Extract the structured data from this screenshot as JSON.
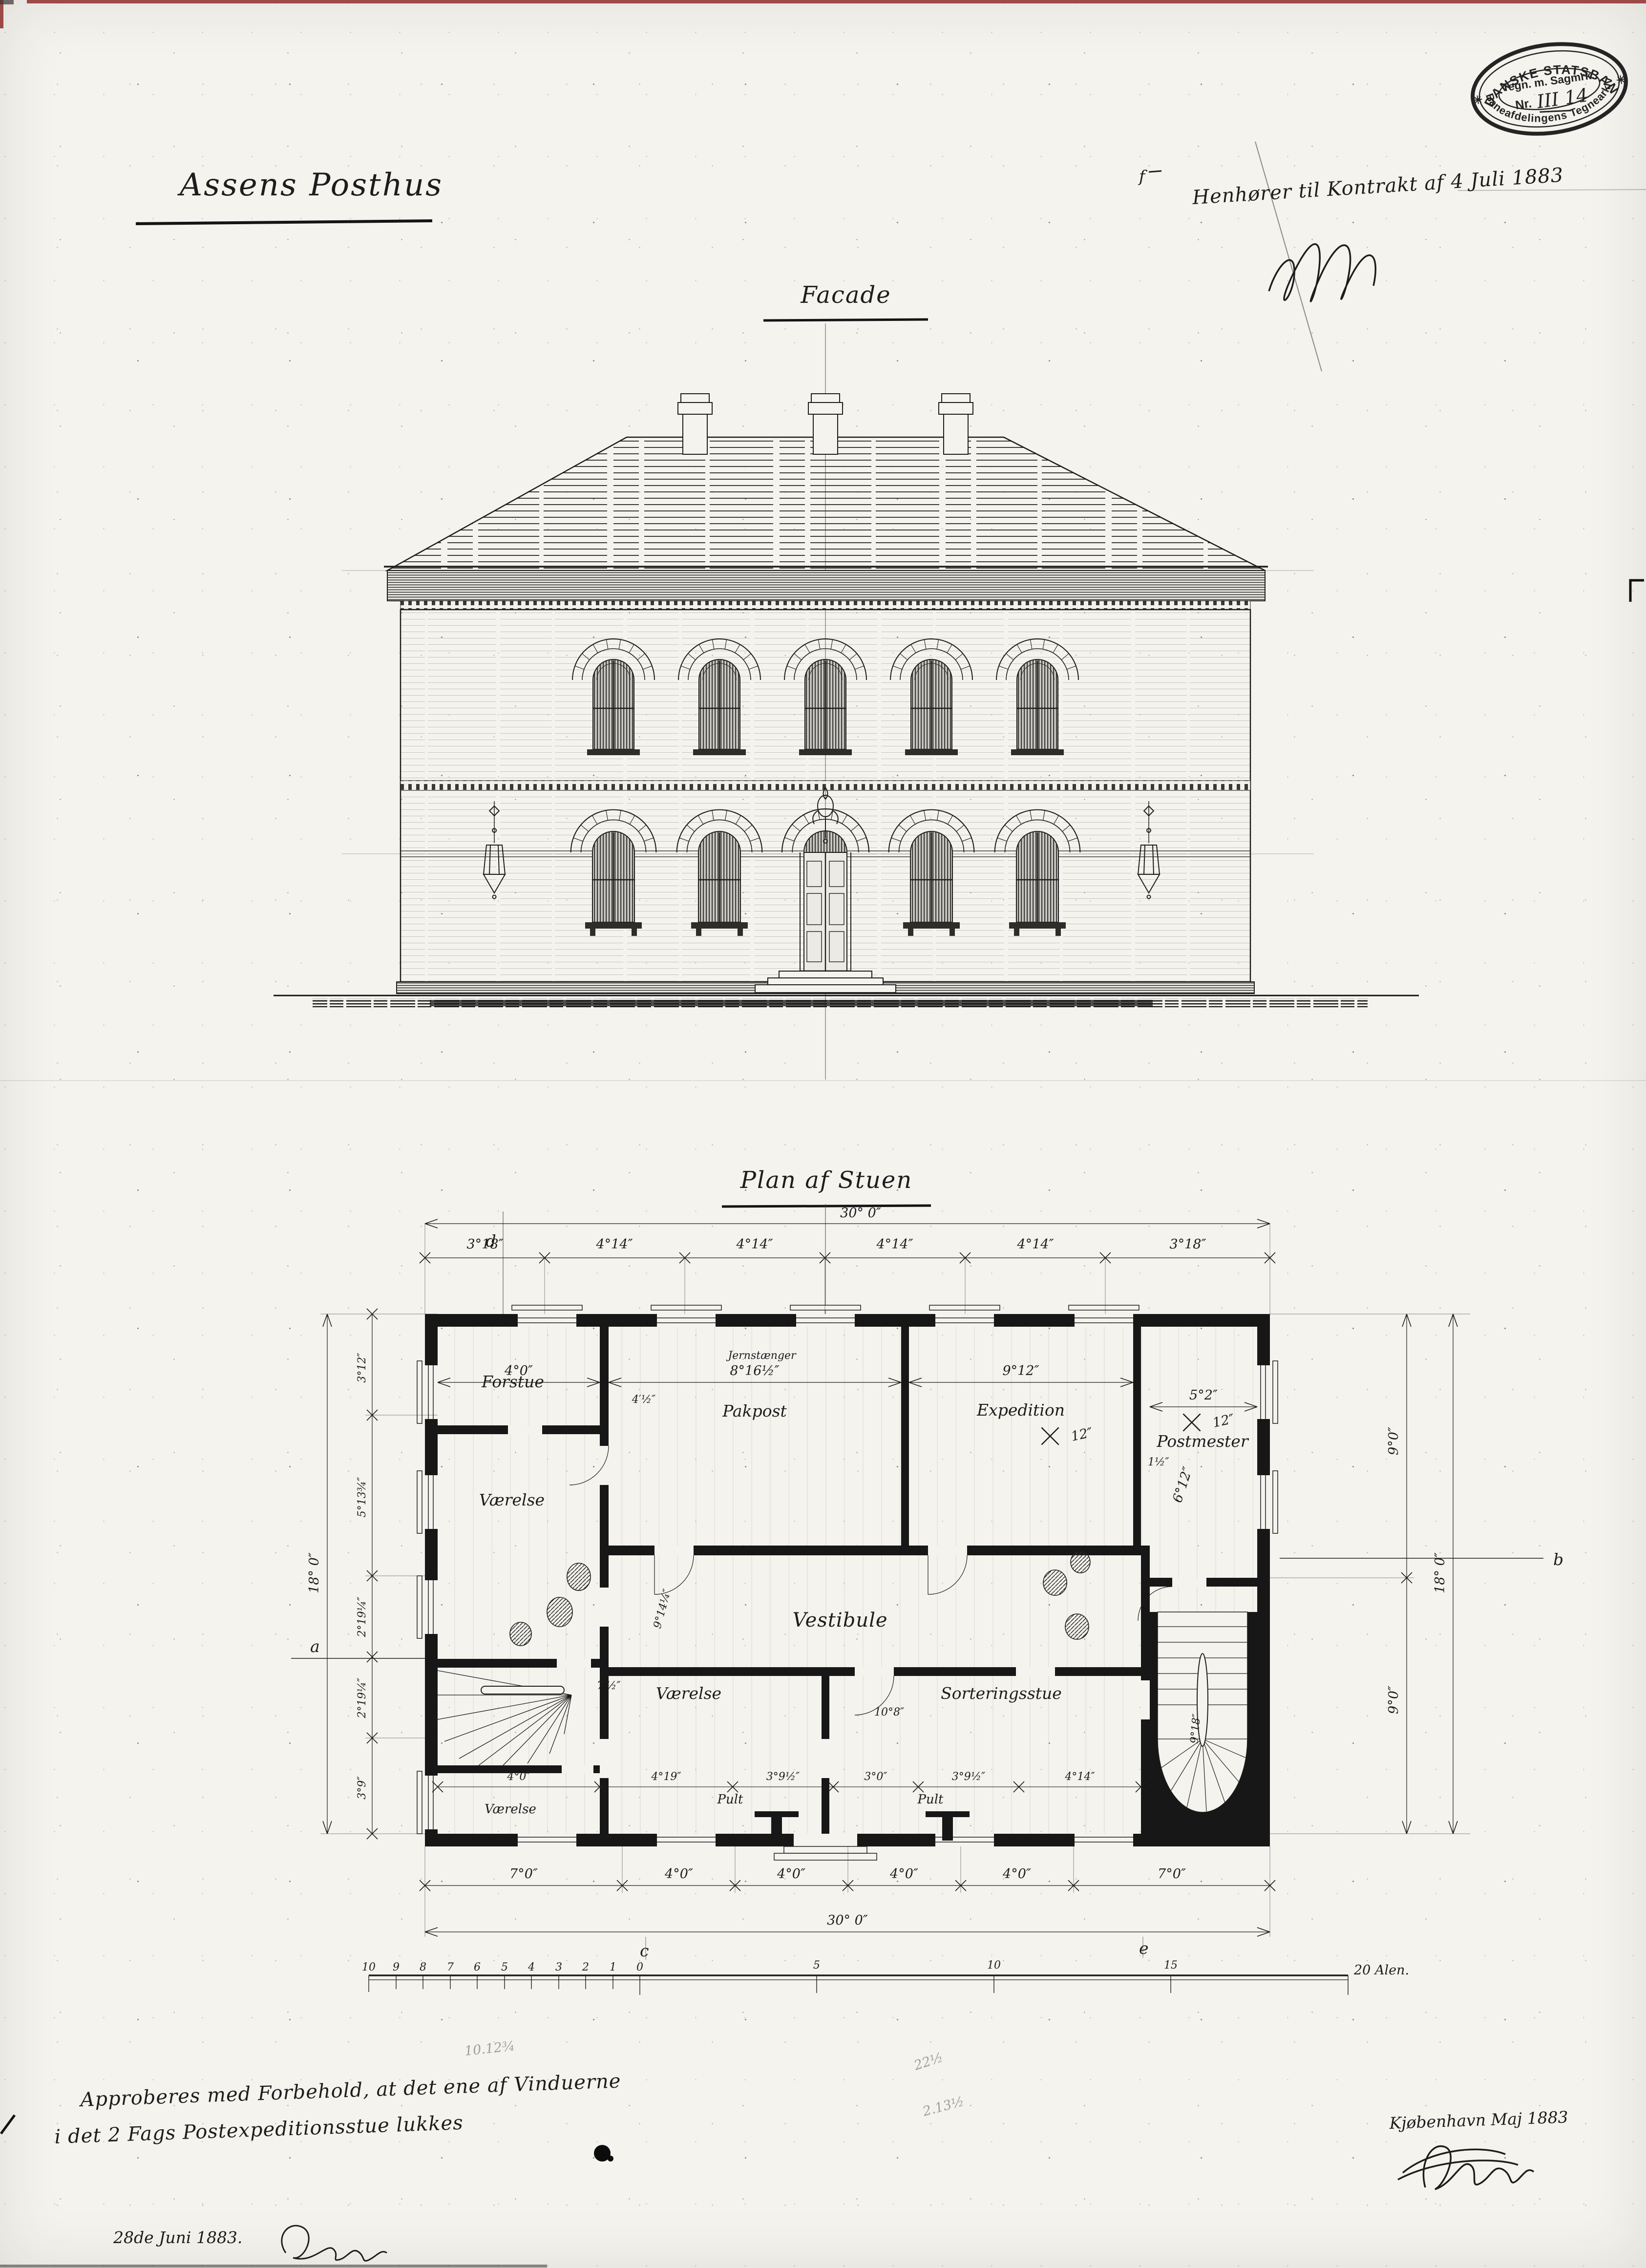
{
  "colors": {
    "paper": "#f5f3ee",
    "ink": "#1d1d1d",
    "stamp": "#242424",
    "red_edge": "#8a2320",
    "pencil": "#6a6a6a"
  },
  "stamp": {
    "arc_top": "DE DANSKE STATSBANER",
    "row1": "Tegn. m. Sagmrk.",
    "row2": "Nr.",
    "number": "III 14",
    "arc_bottom": "Baneafdelingens Tegnearkiv",
    "star": "✳"
  },
  "header": {
    "title": "Assens Posthus",
    "note": "Henhører til Kontrakt af 4 Juli 1883",
    "note_mark": "f"
  },
  "facade": {
    "label": "Facade"
  },
  "plan": {
    "label": "Plan af Stuen",
    "rooms": {
      "forstue": "Forstue",
      "vaerelse": "Værelse",
      "pakpost": "Pakpost",
      "expedition": "Expedition",
      "postmester": "Postmester",
      "vestibule": "Vestibule",
      "sorteringsstue": "Sorteringsstue",
      "pult": "Pult"
    },
    "window_note": "Jernstænger",
    "dims_top_total": "30° 0″",
    "dims_top": [
      "3°18″",
      "4°14″",
      "4°14″",
      "4°14″",
      "4°14″",
      "3°18″"
    ],
    "dims_inner_top": [
      "4°0″",
      "8°16½″",
      "9°12″",
      "5°2″"
    ],
    "dims_right": [
      "9°0″",
      "9°0″"
    ],
    "dims_right_total": "18° 0″",
    "dims_left": [
      "3°12″",
      "5°13¾″",
      "2°19¼″",
      "2°19¼″",
      "3°9″"
    ],
    "dims_left_total": "18° 0″",
    "dims_inner_bottom": [
      "4°0″",
      "4°19″",
      "3°9½″",
      "3°0″",
      "3°9½″",
      "4°14″"
    ],
    "dims_bottom": [
      "7°0″",
      "4°0″",
      "4°0″",
      "4°0″",
      "4°0″",
      "7°0″"
    ],
    "dims_bottom_total": "30° 0″",
    "dims_misc": {
      "postmester_v": "6°12″",
      "stair_v": "9°18″",
      "room_v": "9°14¼″",
      "room_h": "10°8″",
      "wall1": "4′½″",
      "wall2": "7′½″",
      "win": "12″",
      "note_small": "1½″"
    },
    "markers": {
      "a": "a",
      "b": "b",
      "c": "c",
      "d": "d",
      "e": "e"
    },
    "scale_bar": {
      "left": [
        "10",
        "9",
        "8",
        "7",
        "6",
        "5",
        "4",
        "3",
        "2",
        "1",
        "0"
      ],
      "right": [
        "5",
        "10",
        "15"
      ],
      "end": "20 Alen."
    }
  },
  "footer": {
    "approval1": "Approberes med Forbehold, at det ene af Vinduerne",
    "approval2": "i det 2 Fags Postexpeditionsstue lukkes",
    "date": "28de Juni 1883.",
    "city": "Kjøbenhavn Maj 1883",
    "pencil1": "22½",
    "pencil2": "2.13½",
    "pencil3": "10.12¾"
  }
}
